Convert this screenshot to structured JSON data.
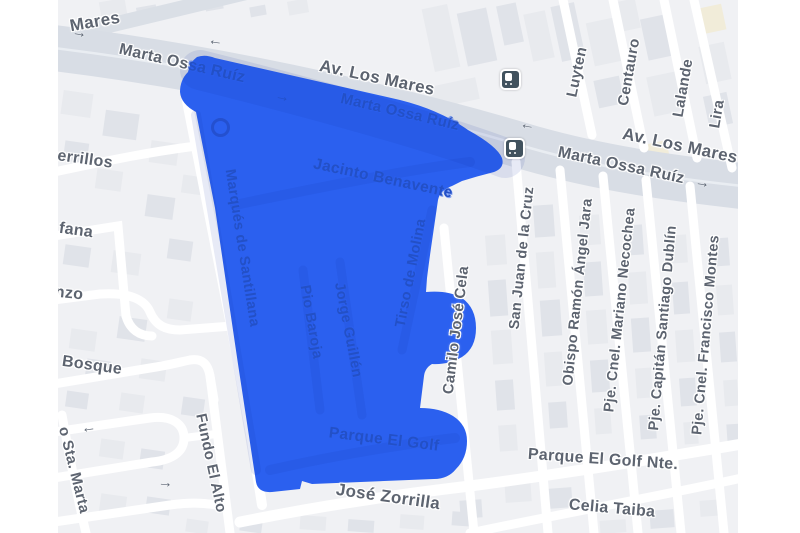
{
  "map_title": "street map with highlighted area",
  "colors": {
    "overlay": "#2b60ef",
    "overlay_label": "#2350c6",
    "road_label_gray": "#5d6470",
    "avenue_gray": "#d8dde5",
    "map_background": "#f0f1f4"
  },
  "glyphs": {
    "arrow_right": "→",
    "arrow_left": "←"
  },
  "icons": {
    "bus_stop": "bus-stop",
    "transit_ring": "transit-ring"
  },
  "streets": {
    "mares_top": "Mares",
    "marta_ossa_outside": "Marta Os",
    "marta_ossa_inside_part": "sa Ruíz",
    "av_los_mares_1": "Av. Los Mares",
    "av_los_mares_2": "Av. Los Mares",
    "marta_ossa_2": "Marta Ossa Ruíz",
    "luyten": "Luyten",
    "centauro": "Centauro",
    "lalande": "Lalande",
    "lira": "Lira",
    "san_juan": "San Juan de la Cruz",
    "obispo": "Obispo Ramón Ángel Jara",
    "necochea": "Pje. Cnel. Mariano Necochea",
    "dublin": "Pje. Capitán Santiago Dublín",
    "montes": "Pje. Cnel. Francisco Montes",
    "camilo": "Camilo José Cela",
    "cerrillos_partial": "errillos",
    "fana_partial": "fana",
    "nzo_partial": "nzo",
    "bosque": "Bosque",
    "sta_marta": "o Sta. Marta",
    "fundo_el_alto": "Fundo El Alto",
    "jose_zorrilla": "José Zorrilla",
    "parque_golf_nte": "Parque El Golf Nte.",
    "celia_taiba": "Celia Taiba",
    "marta_ossa_in": "Marta Ossa Ruíz",
    "jacinto": "Jacinto Benavente",
    "marques": "Marqués de Santillana",
    "pio": "Pio Baroja",
    "jorge": "Jorge Guillén",
    "tirso": "Tirso de Molina",
    "parque_el_golf": "Parque El Golf"
  }
}
